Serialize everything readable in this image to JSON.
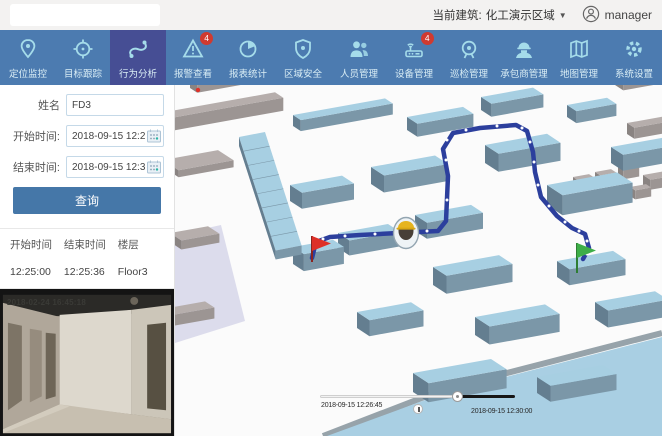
{
  "topbar": {
    "current_building_label": "当前建筑: ",
    "current_building_value": "化工演示区域",
    "caret": "▼",
    "username": "manager"
  },
  "nav": {
    "items": [
      {
        "label": "定位监控",
        "icon": "location-pin",
        "active": false
      },
      {
        "label": "目标跟踪",
        "icon": "target-crosshair",
        "active": false
      },
      {
        "label": "行为分析",
        "icon": "behavior-path",
        "active": true
      },
      {
        "label": "报警查看",
        "icon": "alarm-triangle",
        "badge": "4",
        "active": false
      },
      {
        "label": "报表统计",
        "icon": "pie-chart",
        "active": false
      },
      {
        "label": "区域安全",
        "icon": "shield",
        "active": false
      },
      {
        "label": "人员管理",
        "icon": "people",
        "active": false
      },
      {
        "label": "设备管理",
        "icon": "device-router",
        "badge": "4",
        "active": false
      },
      {
        "label": "巡检管理",
        "icon": "beacon",
        "active": false
      },
      {
        "label": "承包商管理",
        "icon": "worker-helmet",
        "active": false
      },
      {
        "label": "地图管理",
        "icon": "map-folded",
        "active": false
      },
      {
        "label": "系统设置",
        "icon": "gear",
        "active": false
      }
    ]
  },
  "sidebar": {
    "form": {
      "name_label": "姓名",
      "name_value": "FD3",
      "start_label": "开始时间:",
      "start_value": "2018-09-15 12:25:00",
      "end_label": "结束时间:",
      "end_value": "2018-09-15 12:30:00",
      "query_button_label": "查询"
    },
    "results": {
      "headers": [
        "开始时间",
        "结束时间",
        "楼层"
      ],
      "rows": [
        [
          "12:25:00",
          "12:25:36",
          "Floor3"
        ]
      ]
    },
    "video": {
      "osd_timestamp": "2018-02-24 16:45:18"
    }
  },
  "map": {
    "timeline": {
      "current_time": "2018-09-15 12:26:45",
      "end_time": "2018-09-15 12:30:00",
      "progress_percent": 71
    },
    "markers": {
      "start_marker": "red-flag",
      "end_marker": "green-flag",
      "person_marker": "worker-with-helmet"
    }
  },
  "colors": {
    "nav_bg": "#4c7bb0",
    "nav_active_bg": "#464e94",
    "nav_icon": "#a5dcea",
    "badge_red": "#d03a30",
    "query_button": "#4577a8",
    "path_blue": "#2c3f9d",
    "building_top_blue": "#a7cfe2",
    "building_side_blue": "#7b97a8",
    "flag_red": "#dd2f28",
    "flag_green": "#3dae47"
  }
}
